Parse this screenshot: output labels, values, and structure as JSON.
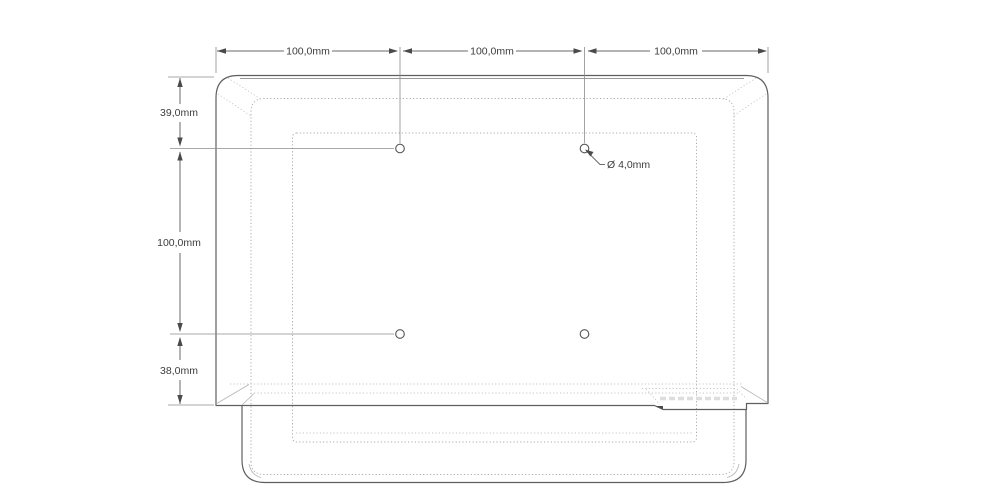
{
  "background": "#ffffff",
  "drawing": {
    "description": "rear-view-cad-drawing-with-vesa-mount-dimensions",
    "colors": {
      "outline_dark": "#5f5f5f",
      "outline_gray": "#9a9a9a",
      "hidden_edge_dotted": "#ababab",
      "dimension_text": "#3d3d3d"
    },
    "dim_top": [
      {
        "label": "100,0mm"
      },
      {
        "label": "100,0mm"
      },
      {
        "label": "100,0mm"
      }
    ],
    "dim_left": [
      {
        "label": "39,0mm"
      },
      {
        "label": "100,0mm"
      },
      {
        "label": "38,0mm"
      }
    ],
    "hole_callout": {
      "label": "Ø 4,0mm"
    }
  }
}
